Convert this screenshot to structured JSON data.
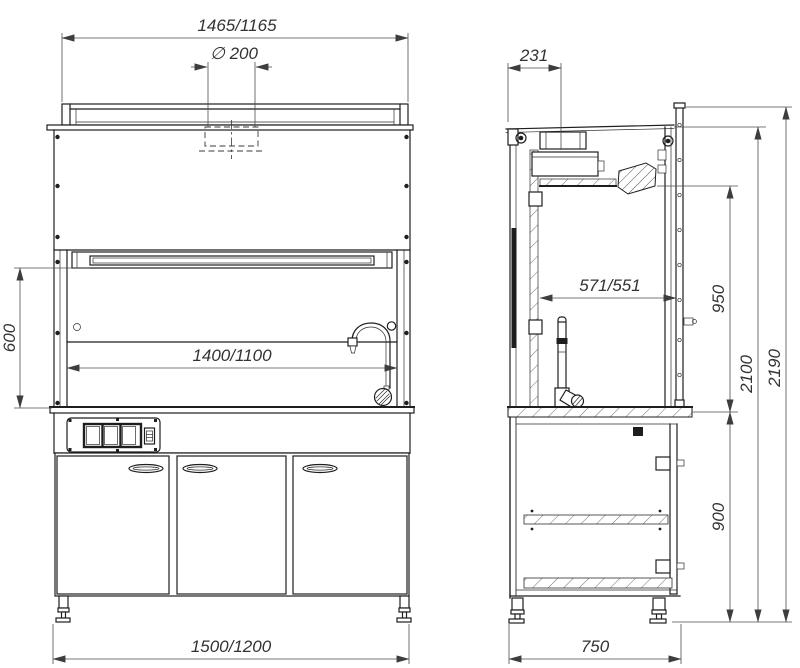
{
  "colors": {
    "line": "#1e1e1e",
    "dim_line": "#4d4d4d",
    "dim_text": "#333333",
    "background": "#ffffff"
  },
  "front_view": {
    "dims": {
      "width_top": "1465/1165",
      "duct": "∅ 200",
      "opening_height": "600",
      "width_inner": "1400/1100",
      "width_bottom": "1500/1200"
    }
  },
  "side_view": {
    "dims": {
      "duct_offset": "231",
      "depth_inner": "571/551",
      "chamber_height": "950",
      "body_height": "2100",
      "total_height": "2190",
      "under_bench_height": "900",
      "depth_bottom": "750"
    }
  }
}
